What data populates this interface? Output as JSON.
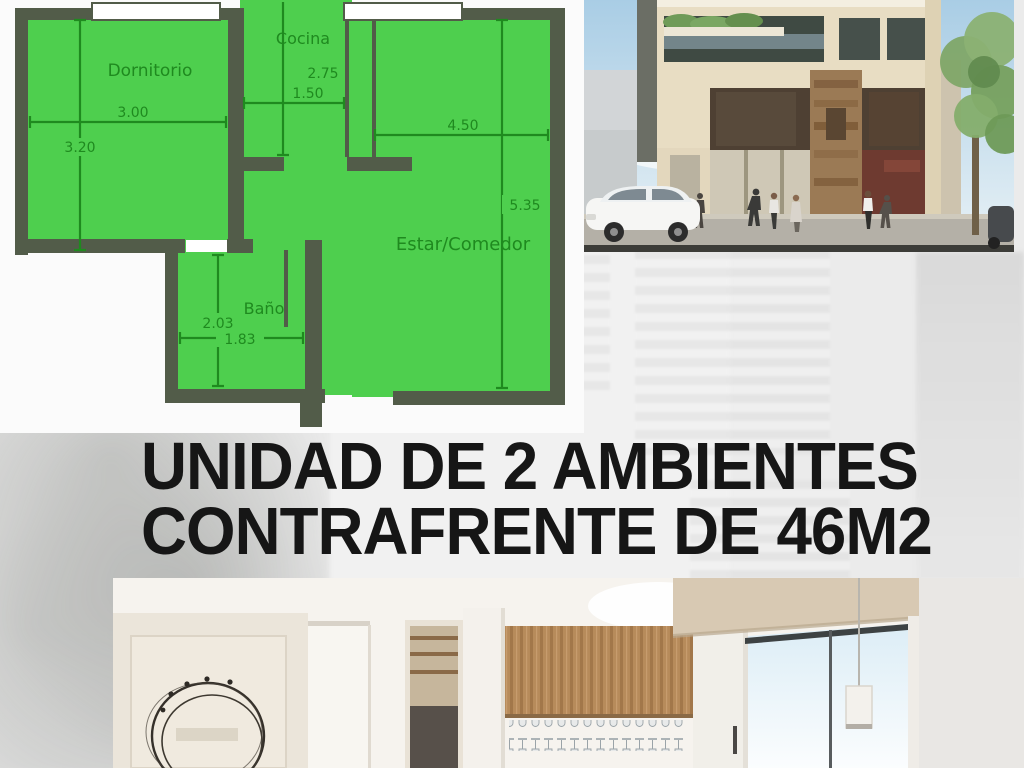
{
  "poster": {
    "headline_line1": "UNIDAD DE 2 AMBIENTES",
    "headline_line2": "CONTRAFRENTE DE 46M2",
    "headline_color": "#161616"
  },
  "floor_plan": {
    "colors": {
      "fill": "#4ecf4e",
      "walls": "#525c49",
      "annotations": "#1f8a1f"
    },
    "rooms": {
      "dormitorio": {
        "label": "Dornitorio",
        "width_m": "3.00",
        "depth_m": "3.20"
      },
      "cocina": {
        "label": "Cocina",
        "depth_m": "2.75",
        "width_m": "1.50"
      },
      "estar_comedor": {
        "label": "Estar/Comedor",
        "width_m": "4.50",
        "depth_m": "5.35"
      },
      "bano": {
        "label": "Baño",
        "depth_m": "2.03",
        "width_m": "1.83"
      }
    }
  },
  "photos": {
    "building_exterior": {
      "name": "building-exterior-render"
    },
    "interior_kitchen": {
      "name": "interior-kitchen-render"
    }
  }
}
